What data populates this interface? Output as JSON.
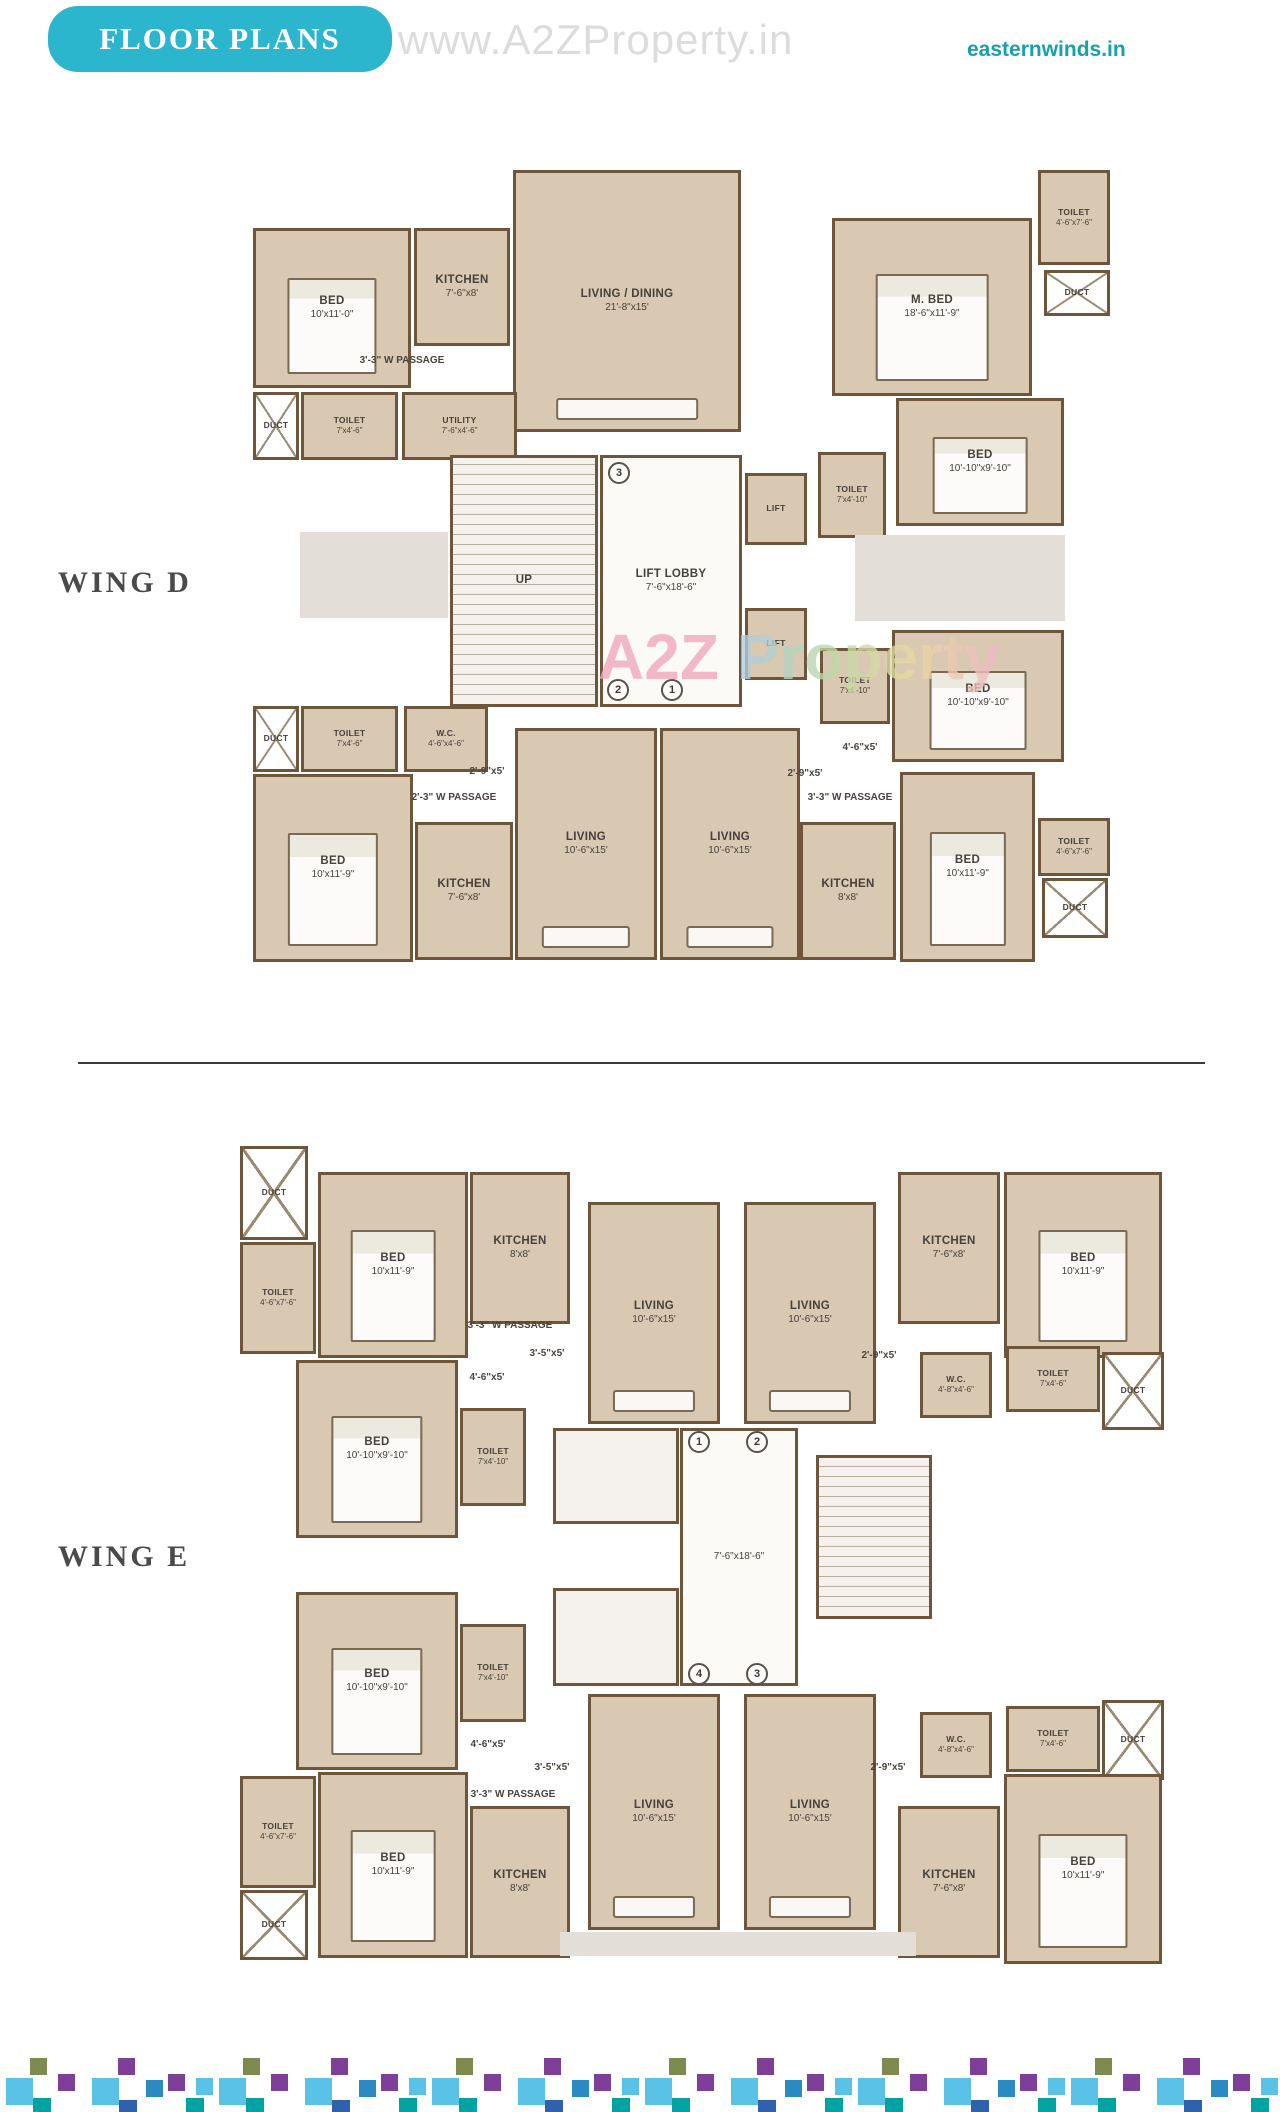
{
  "header": {
    "banner": "FLOOR PLANS",
    "watermark": "www.A2ZProperty.in",
    "site": "easternwinds.in",
    "plan_watermark_a2z": "A2Z ",
    "plan_watermark_property": "Property"
  },
  "colors": {
    "banner_teal": "#2cb6ce",
    "site_teal": "#17a0ad",
    "wall_brown": "#6f5539",
    "room_fill": "#d9c8b2",
    "watermark_gray": "#dcdcdc",
    "watermark_pink": "#f0a8bd"
  },
  "wings": [
    {
      "id": "wing-d",
      "label": "WING D",
      "label_x": 58,
      "label_y": 566,
      "rooms": [
        {
          "name": "BED",
          "dims": "10'x11'-0\"",
          "x": 253,
          "y": 228,
          "w": 158,
          "h": 160,
          "t": "room",
          "furn": "bed"
        },
        {
          "name": "KITCHEN",
          "dims": "7'-6\"x8'",
          "x": 414,
          "y": 228,
          "w": 96,
          "h": 118,
          "t": "room"
        },
        {
          "name": "LIVING / DINING",
          "dims": "21'-8\"x15'",
          "x": 513,
          "y": 170,
          "w": 228,
          "h": 262,
          "t": "room",
          "furn": "sofa"
        },
        {
          "name": "DUCT",
          "dims": "",
          "x": 253,
          "y": 392,
          "w": 46,
          "h": 68,
          "t": "duct"
        },
        {
          "name": "TOILET",
          "dims": "7'x4'-6\"",
          "x": 301,
          "y": 392,
          "w": 97,
          "h": 68,
          "t": "room"
        },
        {
          "name": "UTILITY",
          "dims": "7'-6\"x4'-6\"",
          "x": 402,
          "y": 392,
          "w": 115,
          "h": 68,
          "t": "room"
        },
        {
          "name": "3'-3\" W PASSAGE",
          "dims": "",
          "x": 322,
          "y": 352,
          "w": 160,
          "h": 16,
          "t": "text"
        },
        {
          "name": "M. BED",
          "dims": "18'-6\"x11'-9\"",
          "x": 832,
          "y": 218,
          "w": 200,
          "h": 178,
          "t": "room",
          "furn": "bed"
        },
        {
          "name": "TOILET",
          "dims": "4'-6\"x7'-6\"",
          "x": 1038,
          "y": 170,
          "w": 72,
          "h": 95,
          "t": "room"
        },
        {
          "name": "DUCT",
          "dims": "",
          "x": 1044,
          "y": 270,
          "w": 66,
          "h": 46,
          "t": "duct"
        },
        {
          "name": "BED",
          "dims": "10'-10\"x9'-10\"",
          "x": 896,
          "y": 398,
          "w": 168,
          "h": 128,
          "t": "room",
          "furn": "bed"
        },
        {
          "name": "TOILET",
          "dims": "7'x4'-10\"",
          "x": 818,
          "y": 452,
          "w": 68,
          "h": 86,
          "t": "room"
        },
        {
          "name": "UP",
          "dims": "",
          "x": 450,
          "y": 455,
          "w": 148,
          "h": 252,
          "t": "stairs"
        },
        {
          "name": "LIFT LOBBY",
          "dims": "7'-6\"x18'-6\"",
          "x": 600,
          "y": 455,
          "w": 142,
          "h": 252,
          "t": "lobby"
        },
        {
          "name": "LIFT",
          "dims": "",
          "x": 745,
          "y": 473,
          "w": 62,
          "h": 72,
          "t": "lift"
        },
        {
          "name": "LIFT",
          "dims": "",
          "x": 745,
          "y": 608,
          "w": 62,
          "h": 72,
          "t": "lift"
        },
        {
          "name": "",
          "dims": "",
          "x": 300,
          "y": 532,
          "w": 148,
          "h": 86,
          "t": "gray"
        },
        {
          "name": "",
          "dims": "",
          "x": 855,
          "y": 535,
          "w": 210,
          "h": 86,
          "t": "gray"
        },
        {
          "name": "TOILET",
          "dims": "7'x4'-10\"",
          "x": 820,
          "y": 648,
          "w": 70,
          "h": 76,
          "t": "room"
        },
        {
          "name": "BED",
          "dims": "10'-10\"x9'-10\"",
          "x": 892,
          "y": 630,
          "w": 172,
          "h": 132,
          "t": "room",
          "furn": "bed"
        },
        {
          "name": "DUCT",
          "dims": "",
          "x": 253,
          "y": 706,
          "w": 46,
          "h": 66,
          "t": "duct"
        },
        {
          "name": "TOILET",
          "dims": "7'x4'-6\"",
          "x": 301,
          "y": 706,
          "w": 97,
          "h": 66,
          "t": "room"
        },
        {
          "name": "W.C.",
          "dims": "4'-6\"x4'-6\"",
          "x": 404,
          "y": 706,
          "w": 84,
          "h": 66,
          "t": "room"
        },
        {
          "name": "BED",
          "dims": "10'x11'-9\"",
          "x": 253,
          "y": 774,
          "w": 160,
          "h": 188,
          "t": "room",
          "furn": "bed"
        },
        {
          "name": "KITCHEN",
          "dims": "7'-6\"x8'",
          "x": 415,
          "y": 822,
          "w": 98,
          "h": 138,
          "t": "room"
        },
        {
          "name": "LIVING",
          "dims": "10'-6\"x15'",
          "x": 515,
          "y": 728,
          "w": 142,
          "h": 232,
          "t": "room",
          "furn": "sofa"
        },
        {
          "name": "LIVING",
          "dims": "10'-6\"x15'",
          "x": 660,
          "y": 728,
          "w": 140,
          "h": 232,
          "t": "room",
          "furn": "sofa"
        },
        {
          "name": "2'-9\"x5'",
          "dims": "",
          "x": 442,
          "y": 764,
          "w": 90,
          "h": 14,
          "t": "text"
        },
        {
          "name": "2'-3\" W PASSAGE",
          "dims": "",
          "x": 380,
          "y": 790,
          "w": 148,
          "h": 14,
          "t": "text"
        },
        {
          "name": "4'-6\"x5'",
          "dims": "",
          "x": 815,
          "y": 740,
          "w": 90,
          "h": 14,
          "t": "text"
        },
        {
          "name": "2'-9\"x5'",
          "dims": "",
          "x": 762,
          "y": 766,
          "w": 86,
          "h": 14,
          "t": "text"
        },
        {
          "name": "3'-3\" W PASSAGE",
          "dims": "",
          "x": 775,
          "y": 790,
          "w": 150,
          "h": 14,
          "t": "text"
        },
        {
          "name": "KITCHEN",
          "dims": "8'x8'",
          "x": 800,
          "y": 822,
          "w": 96,
          "h": 138,
          "t": "room"
        },
        {
          "name": "BED",
          "dims": "10'x11'-9\"",
          "x": 900,
          "y": 772,
          "w": 135,
          "h": 190,
          "t": "room",
          "furn": "bed"
        },
        {
          "name": "TOILET",
          "dims": "4'-6\"x7'-6\"",
          "x": 1038,
          "y": 818,
          "w": 72,
          "h": 58,
          "t": "room"
        },
        {
          "name": "DUCT",
          "dims": "",
          "x": 1042,
          "y": 878,
          "w": 66,
          "h": 60,
          "t": "duct"
        }
      ],
      "markers": [
        {
          "n": "3",
          "x": 619,
          "y": 473
        },
        {
          "n": "2",
          "x": 618,
          "y": 690
        },
        {
          "n": "1",
          "x": 672,
          "y": 690
        }
      ]
    },
    {
      "id": "wing-e",
      "label": "WING E",
      "label_x": 58,
      "label_y": 1540,
      "rooms": [
        {
          "name": "DUCT",
          "dims": "",
          "x": 240,
          "y": 1146,
          "w": 68,
          "h": 94,
          "t": "duct"
        },
        {
          "name": "TOILET",
          "dims": "4'-6\"x7'-6\"",
          "x": 240,
          "y": 1242,
          "w": 76,
          "h": 112,
          "t": "room"
        },
        {
          "name": "BED",
          "dims": "10'x11'-9\"",
          "x": 318,
          "y": 1172,
          "w": 150,
          "h": 186,
          "t": "room",
          "furn": "bed"
        },
        {
          "name": "KITCHEN",
          "dims": "8'x8'",
          "x": 470,
          "y": 1172,
          "w": 100,
          "h": 152,
          "t": "room"
        },
        {
          "name": "3'-3\" W PASSAGE",
          "dims": "",
          "x": 430,
          "y": 1318,
          "w": 160,
          "h": 14,
          "t": "text"
        },
        {
          "name": "4'-6\"x5'",
          "dims": "",
          "x": 442,
          "y": 1370,
          "w": 90,
          "h": 14,
          "t": "text"
        },
        {
          "name": "3'-5\"x5'",
          "dims": "",
          "x": 505,
          "y": 1346,
          "w": 84,
          "h": 14,
          "t": "text"
        },
        {
          "name": "BED",
          "dims": "10'-10\"x9'-10\"",
          "x": 296,
          "y": 1360,
          "w": 162,
          "h": 178,
          "t": "room",
          "furn": "bed"
        },
        {
          "name": "TOILET",
          "dims": "7'x4'-10\"",
          "x": 460,
          "y": 1408,
          "w": 66,
          "h": 98,
          "t": "room"
        },
        {
          "name": "LIVING",
          "dims": "10'-6\"x15'",
          "x": 588,
          "y": 1202,
          "w": 132,
          "h": 222,
          "t": "room",
          "furn": "sofa"
        },
        {
          "name": "LIVING",
          "dims": "10'-6\"x15'",
          "x": 744,
          "y": 1202,
          "w": 132,
          "h": 222,
          "t": "room",
          "furn": "sofa"
        },
        {
          "name": "2'-9\"x5'",
          "dims": "",
          "x": 836,
          "y": 1348,
          "w": 86,
          "h": 14,
          "t": "text"
        },
        {
          "name": "KITCHEN",
          "dims": "7'-6\"x8'",
          "x": 898,
          "y": 1172,
          "w": 102,
          "h": 152,
          "t": "room"
        },
        {
          "name": "BED",
          "dims": "10'x11'-9\"",
          "x": 1004,
          "y": 1172,
          "w": 158,
          "h": 186,
          "t": "room",
          "furn": "bed"
        },
        {
          "name": "W.C.",
          "dims": "4'-8\"x4'-6\"",
          "x": 920,
          "y": 1352,
          "w": 72,
          "h": 66,
          "t": "room"
        },
        {
          "name": "TOILET",
          "dims": "7'x4'-6\"",
          "x": 1006,
          "y": 1346,
          "w": 94,
          "h": 66,
          "t": "room"
        },
        {
          "name": "DUCT",
          "dims": "",
          "x": 1102,
          "y": 1352,
          "w": 62,
          "h": 78,
          "t": "duct"
        },
        {
          "name": "",
          "dims": "",
          "x": 553,
          "y": 1428,
          "w": 126,
          "h": 96,
          "t": "core"
        },
        {
          "name": "",
          "dims": "",
          "x": 553,
          "y": 1588,
          "w": 126,
          "h": 98,
          "t": "core"
        },
        {
          "name": "",
          "dims": "7'-6\"x18'-6\"",
          "x": 680,
          "y": 1428,
          "w": 118,
          "h": 258,
          "t": "lobby"
        },
        {
          "name": "",
          "dims": "",
          "x": 816,
          "y": 1455,
          "w": 116,
          "h": 164,
          "t": "stairs"
        },
        {
          "name": "BED",
          "dims": "10'-10\"x9'-10\"",
          "x": 296,
          "y": 1592,
          "w": 162,
          "h": 178,
          "t": "room",
          "furn": "bed"
        },
        {
          "name": "TOILET",
          "dims": "7'x4'-10\"",
          "x": 460,
          "y": 1624,
          "w": 66,
          "h": 98,
          "t": "room"
        },
        {
          "name": "4'-6\"x5'",
          "dims": "",
          "x": 443,
          "y": 1737,
          "w": 90,
          "h": 14,
          "t": "text"
        },
        {
          "name": "3'-5\"x5'",
          "dims": "",
          "x": 510,
          "y": 1760,
          "w": 84,
          "h": 14,
          "t": "text"
        },
        {
          "name": "3'-3\" W PASSAGE",
          "dims": "",
          "x": 433,
          "y": 1787,
          "w": 160,
          "h": 14,
          "t": "text"
        },
        {
          "name": "BED",
          "dims": "10'x11'-9\"",
          "x": 318,
          "y": 1772,
          "w": 150,
          "h": 186,
          "t": "room",
          "furn": "bed"
        },
        {
          "name": "TOILET",
          "dims": "4'-6\"x7'-6\"",
          "x": 240,
          "y": 1776,
          "w": 76,
          "h": 112,
          "t": "room"
        },
        {
          "name": "DUCT",
          "dims": "",
          "x": 240,
          "y": 1890,
          "w": 68,
          "h": 70,
          "t": "duct"
        },
        {
          "name": "KITCHEN",
          "dims": "8'x8'",
          "x": 470,
          "y": 1806,
          "w": 100,
          "h": 152,
          "t": "room"
        },
        {
          "name": "LIVING",
          "dims": "10'-6\"x15'",
          "x": 588,
          "y": 1694,
          "w": 132,
          "h": 236,
          "t": "room",
          "furn": "sofa"
        },
        {
          "name": "LIVING",
          "dims": "10'-6\"x15'",
          "x": 744,
          "y": 1694,
          "w": 132,
          "h": 236,
          "t": "room",
          "furn": "sofa"
        },
        {
          "name": "2'-9\"x5'",
          "dims": "",
          "x": 845,
          "y": 1760,
          "w": 86,
          "h": 14,
          "t": "text"
        },
        {
          "name": "W.C.",
          "dims": "4'-8\"x4'-6\"",
          "x": 920,
          "y": 1712,
          "w": 72,
          "h": 66,
          "t": "room"
        },
        {
          "name": "TOILET",
          "dims": "7'x4'-6\"",
          "x": 1006,
          "y": 1706,
          "w": 94,
          "h": 66,
          "t": "room"
        },
        {
          "name": "DUCT",
          "dims": "",
          "x": 1102,
          "y": 1700,
          "w": 62,
          "h": 80,
          "t": "duct"
        },
        {
          "name": "BED",
          "dims": "10'x11'-9\"",
          "x": 1004,
          "y": 1774,
          "w": 158,
          "h": 190,
          "t": "room",
          "furn": "bed"
        },
        {
          "name": "KITCHEN",
          "dims": "7'-6\"x8'",
          "x": 898,
          "y": 1806,
          "w": 102,
          "h": 152,
          "t": "room"
        },
        {
          "name": "",
          "dims": "",
          "x": 560,
          "y": 1932,
          "w": 356,
          "h": 24,
          "t": "gray"
        }
      ],
      "markers": [
        {
          "n": "1",
          "x": 699,
          "y": 1442
        },
        {
          "n": "2",
          "x": 757,
          "y": 1442
        },
        {
          "n": "4",
          "x": 699,
          "y": 1674
        },
        {
          "n": "3",
          "x": 757,
          "y": 1674
        }
      ]
    }
  ],
  "mosaic": {
    "top": 2058,
    "tile_width": 213,
    "repeats": 6,
    "palette": {
      "lblue": "#5bc2e7",
      "teal": "#00a3a1",
      "royal": "#3061ae",
      "mblue": "#2b8ac2",
      "purple": "#7d3f98",
      "olive": "#7e8b4e"
    },
    "cells": [
      {
        "x": 30,
        "y": 0,
        "s": 17,
        "c": "olive"
      },
      {
        "x": 118,
        "y": 0,
        "s": 17,
        "c": "purple"
      },
      {
        "x": 6,
        "y": 20,
        "s": 27,
        "c": "lblue"
      },
      {
        "x": 58,
        "y": 16,
        "s": 17,
        "c": "purple"
      },
      {
        "x": 33,
        "y": 40,
        "s": 18,
        "c": "teal"
      },
      {
        "x": 92,
        "y": 20,
        "s": 27,
        "c": "lblue"
      },
      {
        "x": 119,
        "y": 42,
        "s": 18,
        "c": "royal"
      },
      {
        "x": 146,
        "y": 22,
        "s": 17,
        "c": "mblue"
      },
      {
        "x": 168,
        "y": 16,
        "s": 17,
        "c": "purple"
      },
      {
        "x": 186,
        "y": 40,
        "s": 18,
        "c": "teal"
      },
      {
        "x": 196,
        "y": 20,
        "s": 17,
        "c": "lblue"
      }
    ]
  }
}
